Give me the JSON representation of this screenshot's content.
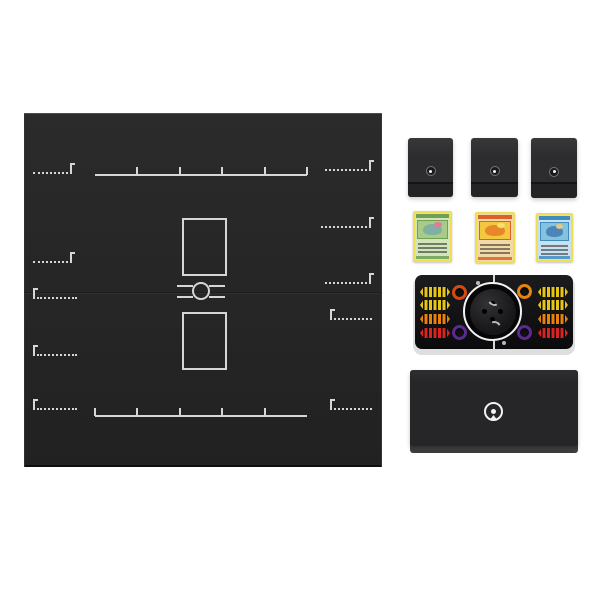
{
  "scene": {
    "type": "product-photo",
    "subject": "Pokemon trading card game playmat and accessories set",
    "background_color": "#ffffff"
  },
  "playmat": {
    "x": 24,
    "y": 113,
    "width": 358,
    "height": 354,
    "surface_color": "#262626",
    "surface_gradient_top": "#2b2b2b",
    "surface_gradient_bottom": "#212121",
    "line_color": "#d6d6d6",
    "fold_seam_y": 179,
    "fold_seam_dark": "#141414",
    "fold_seam_light": "#3a3a3a",
    "benches": [
      {
        "x": 71,
        "y": 61,
        "width": 212,
        "ticks": [
          42,
          85,
          127,
          170,
          212
        ]
      },
      {
        "x": 71,
        "y": 302,
        "width": 212,
        "ticks": [
          0,
          42,
          85,
          127,
          170
        ]
      }
    ],
    "corner_markers": [
      {
        "x": 9,
        "y": 60,
        "width": 39,
        "corner": "right"
      },
      {
        "x": 9,
        "y": 149,
        "width": 39,
        "corner": "right"
      },
      {
        "x": 301,
        "y": 57,
        "width": 46,
        "corner": "right"
      },
      {
        "x": 297,
        "y": 114,
        "width": 50,
        "corner": "right"
      },
      {
        "x": 301,
        "y": 170,
        "width": 46,
        "corner": "right"
      },
      {
        "x": 9,
        "y": 185,
        "width": 44,
        "corner": "left"
      },
      {
        "x": 9,
        "y": 242,
        "width": 44,
        "corner": "left"
      },
      {
        "x": 9,
        "y": 296,
        "width": 44,
        "corner": "left"
      },
      {
        "x": 306,
        "y": 206,
        "width": 42,
        "corner": "left"
      },
      {
        "x": 306,
        "y": 296,
        "width": 42,
        "corner": "left"
      }
    ],
    "stadium_zones": [
      {
        "x": 158,
        "y": 105,
        "width": 41,
        "height": 54
      },
      {
        "x": 158,
        "y": 199,
        "width": 41,
        "height": 54
      }
    ],
    "center_circle": {
      "cx": 177,
      "cy": 178,
      "r": 9
    },
    "center_lines": [
      {
        "x": 153,
        "y": 172,
        "width": 16
      },
      {
        "x": 185,
        "y": 172,
        "width": 16
      },
      {
        "x": 153,
        "y": 183,
        "width": 16
      },
      {
        "x": 185,
        "y": 183,
        "width": 16
      }
    ]
  },
  "deck_boxes": {
    "body_color": "#2d2d2f",
    "lid_highlight": "#38383a",
    "base_color": "#232325",
    "seam_color": "#141416",
    "emblem_ring_color": "#77777a",
    "emblem_dot_color": "#f2f2f2",
    "items": [
      {
        "x": 408,
        "y": 138,
        "width": 45,
        "height": 59
      },
      {
        "x": 471,
        "y": 138,
        "width": 47,
        "height": 59
      },
      {
        "x": 531,
        "y": 138,
        "width": 46,
        "height": 60
      }
    ]
  },
  "cards": {
    "border_color": "#f0df52",
    "text_line_color": "rgba(0,0,0,0.45)",
    "items": [
      {
        "name": "venusaur-card",
        "x": 413,
        "y": 211,
        "width": 39,
        "height": 51,
        "frame_color": "#6fa055",
        "art_color": "#a8cc86",
        "body_color": "#d2e4ba",
        "creature_color": "#7fb0a4",
        "accent_color": "#e8789a"
      },
      {
        "name": "charizard-card",
        "x": 475,
        "y": 212,
        "width": 40,
        "height": 51,
        "frame_color": "#de5f2a",
        "art_color": "#f2c93e",
        "body_color": "#f2d9a8",
        "creature_color": "#e8862c",
        "accent_color": "#f5e06a"
      },
      {
        "name": "blastoise-card",
        "x": 536,
        "y": 213,
        "width": 37,
        "height": 49,
        "frame_color": "#3f8cc0",
        "art_color": "#85c2de",
        "body_color": "#c9e0ee",
        "creature_color": "#4a86b8",
        "accent_color": "#e6c87e"
      }
    ]
  },
  "counter_tray": {
    "x": 415,
    "y": 275,
    "width": 158,
    "height": 74,
    "rim_color": "#dedede",
    "shell_top_color": "#1c1c1e",
    "shell_bottom_color": "#0b0b0d",
    "divider_color": "#efefef",
    "divider_x": 78,
    "ring_color": "#f2f2f2",
    "circle": {
      "cx": 78,
      "cy": 37,
      "r": 30
    },
    "die_puck_color": "#161618",
    "die_pip_color": "#000000",
    "die_notch_color": "#b8b8b8",
    "ring_dice": [
      {
        "cx": 45,
        "cy": 18,
        "color": "#d8490f"
      },
      {
        "cx": 110,
        "cy": 17,
        "color": "#e8820f"
      },
      {
        "cx": 45,
        "cy": 58,
        "color": "#5b2a8e"
      },
      {
        "cx": 110,
        "cy": 58,
        "color": "#5b2a8e"
      }
    ],
    "counter_ridge_color": "rgba(0,0,0,0.5)",
    "counters_left": [
      {
        "cy": 17,
        "color": "#e5c517"
      },
      {
        "cy": 30,
        "color": "#e5c517"
      },
      {
        "cy": 44,
        "color": "#e8820f"
      },
      {
        "cy": 58,
        "color": "#d92323"
      }
    ],
    "counters_right": [
      {
        "cy": 17,
        "color": "#e5c517"
      },
      {
        "cy": 30,
        "color": "#e5c517"
      },
      {
        "cy": 44,
        "color": "#e8820f"
      },
      {
        "cy": 58,
        "color": "#d92323"
      }
    ],
    "counter_x_left": 5,
    "counter_x_right": 123,
    "counter_width": 30,
    "counter_height": 10,
    "mini_pokeball_dots": [
      {
        "cx": 63,
        "cy": 8
      },
      {
        "cx": 89,
        "cy": 68
      }
    ]
  },
  "storage_box": {
    "x": 410,
    "y": 370,
    "width": 168,
    "height": 83,
    "face_height": 76,
    "face_color": "#262628",
    "face_highlight": "#2e2e30",
    "edge_color": "#3d3d3f",
    "emblem_color": "#f2f2f2",
    "emblem": {
      "cx": 84,
      "cy": 42,
      "r": 10
    }
  }
}
